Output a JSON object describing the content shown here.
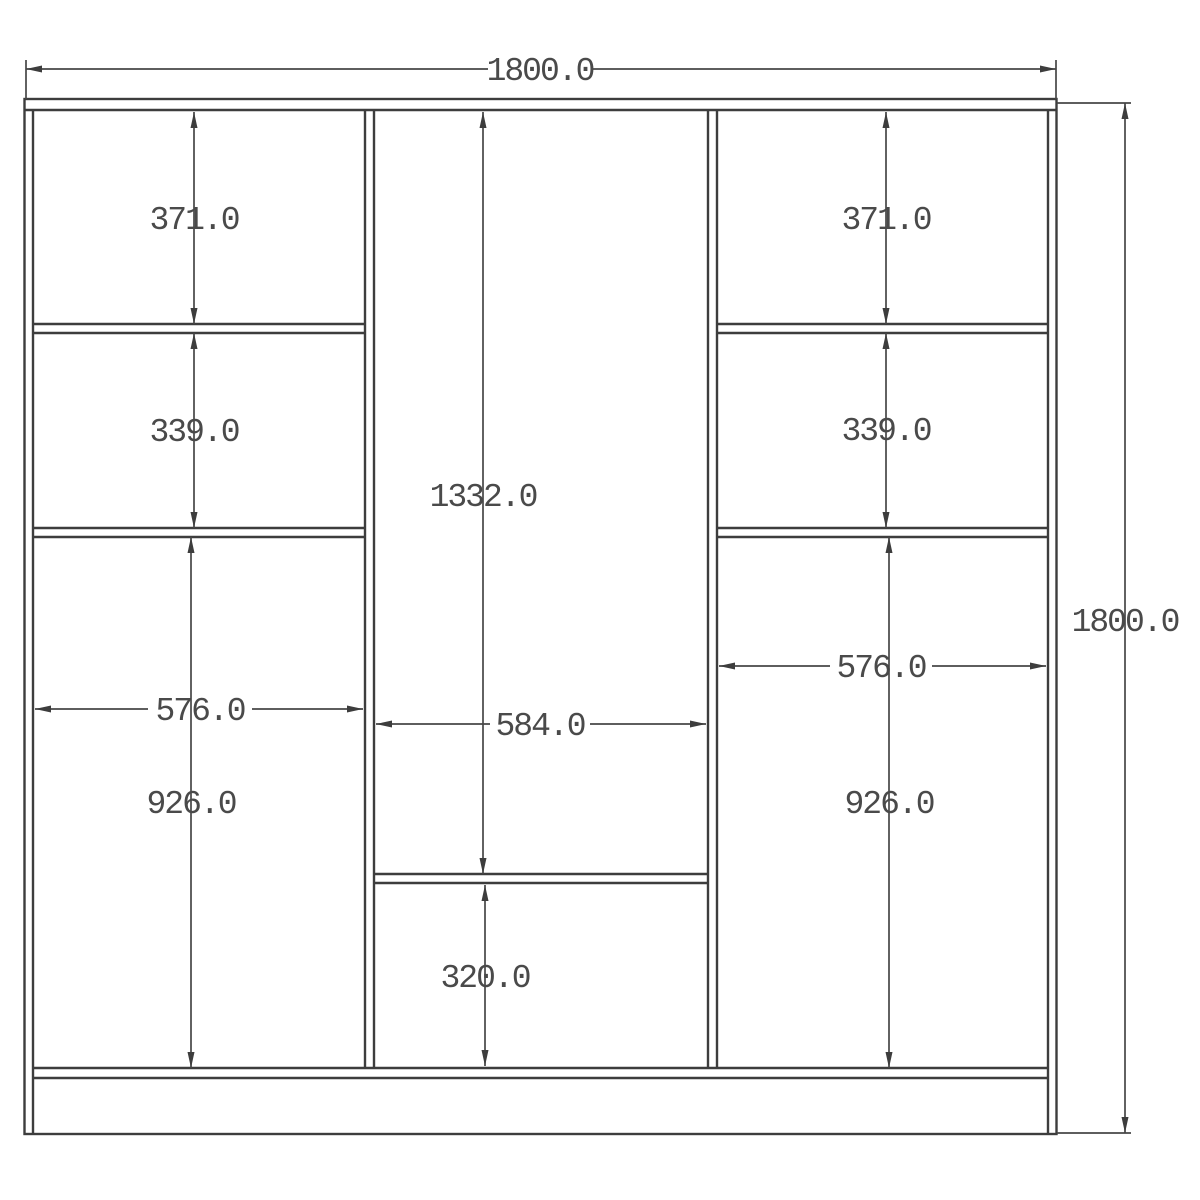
{
  "drawing": {
    "type": "furniture-dimension-drawing",
    "units_suffix": ".0",
    "colors": {
      "background": "#ffffff",
      "line": "#3d3d3d",
      "dimension_line": "#474747",
      "text": "#4a4a4a"
    },
    "dims": {
      "overall_width": "1800.0",
      "overall_height": "1800.0",
      "left": {
        "top": "371.0",
        "mid": "339.0",
        "width": "576.0",
        "bottom": "926.0"
      },
      "center": {
        "upper": "1332.0",
        "width": "584.0",
        "lower": "320.0"
      },
      "right": {
        "top": "371.0",
        "mid": "339.0",
        "width": "576.0",
        "bottom": "926.0"
      }
    }
  }
}
